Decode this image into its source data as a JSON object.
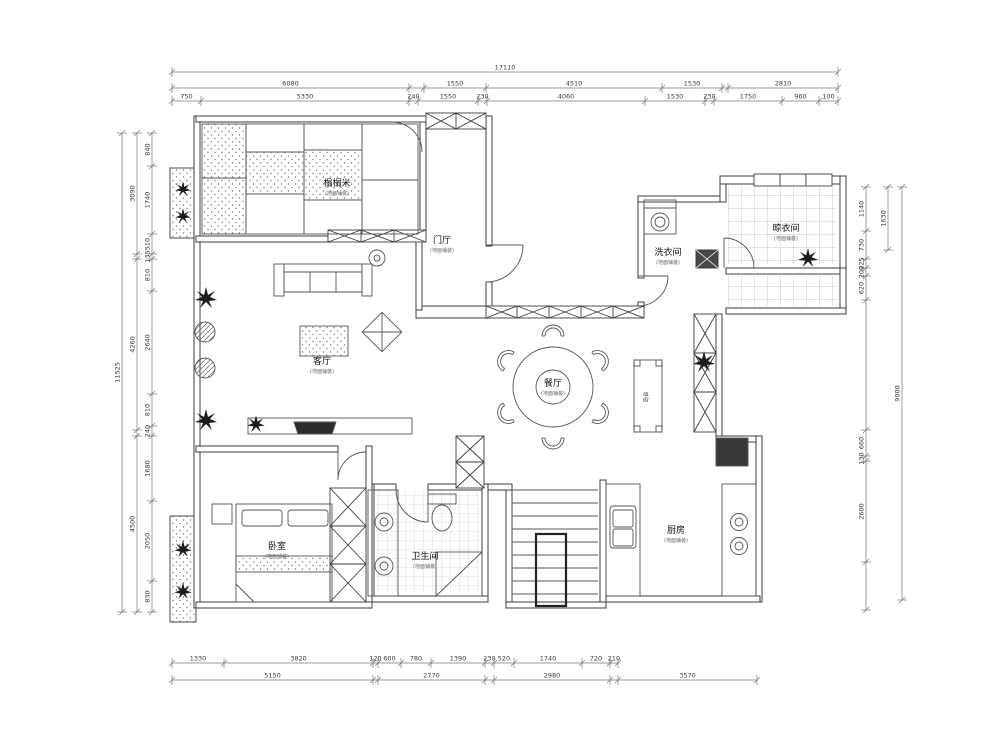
{
  "rooms": [
    {
      "name": "榻榻米",
      "sub": "(地面铺装)"
    },
    {
      "name": "门厅",
      "sub": "(地面铺装)"
    },
    {
      "name": "客厅",
      "sub": "(地面铺装)"
    },
    {
      "name": "餐厅",
      "sub": "(地面铺装)"
    },
    {
      "name": "洗衣间",
      "sub": "(地面铺装)"
    },
    {
      "name": "晾衣间",
      "sub": "(地面铺装)"
    },
    {
      "name": "卧室",
      "sub": "(地面铺装)"
    },
    {
      "name": "卫生间",
      "sub": "(地面铺装)"
    },
    {
      "name": "厨房",
      "sub": "(地面铺装)"
    }
  ],
  "labels": {
    "island": "岛台"
  },
  "dims": {
    "top1": [
      "17110"
    ],
    "top2": [
      "6080",
      "",
      "1550",
      "4510",
      "1530",
      "",
      "2810"
    ],
    "top3": [
      "750",
      "5330",
      "240",
      "1550",
      "230",
      "4060",
      "1530",
      "230",
      "1750",
      "960",
      "100"
    ],
    "left1": [
      "11525"
    ],
    "left2": [
      "3090",
      "",
      "4260",
      "",
      "4500"
    ],
    "left3": [
      "840",
      "1740",
      "510",
      "135",
      "810",
      "2640",
      "810",
      "240",
      "1680",
      "2050",
      "830"
    ],
    "right1": [
      "9000"
    ],
    "right2": [
      "1630"
    ],
    "right3": [
      "1140",
      "730",
      "225",
      "200",
      "620",
      "",
      "660",
      "130",
      "2600",
      ""
    ],
    "bottom1": [
      "1330",
      "3820",
      "120",
      "600",
      "780",
      "1390",
      "230",
      "520",
      "1740",
      "720",
      "210"
    ],
    "bottom2": [
      "5150",
      "",
      "2770",
      "",
      "2980",
      "",
      "3570"
    ]
  }
}
